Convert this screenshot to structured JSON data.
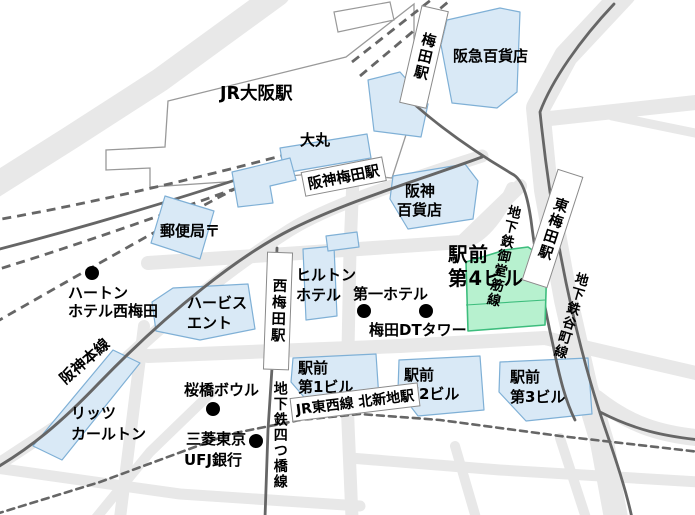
{
  "labels": {
    "jr_osaka": "JR大阪駅",
    "umeda_station": "梅田駅",
    "hankyu_dept": "阪急百貨店",
    "daimaru": "大丸",
    "hanshin_umeda_station": "阪神梅田駅",
    "hanshin_dept_line1": "阪神",
    "hanshin_dept_line2": "百貨店",
    "post_office": "郵便局〒",
    "hearton_line1": "ハートン",
    "hearton_line2": "ホテル西梅田",
    "hilton_line1": "ヒルトン",
    "hilton_line2": "ホテル",
    "daiichi_hotel": "第一ホテル",
    "umeda_dt_tower": "梅田DTタワー",
    "ekimae4_line1": "駅前",
    "ekimae4_line2": "第4ビル",
    "higashi_umeda_station": "東梅田駅",
    "midosuji_line": "地下鉄御堂筋線",
    "tanimachi_line": "地下鉄谷町線",
    "herbis_line1": "ハービス",
    "herbis_line2": "エント",
    "nishi_umeda_station": "西梅田駅",
    "hanshin_main_line": "阪神本線",
    "ekimae1_line1": "駅前",
    "ekimae1_line2": "第1ビル",
    "ekimae2_line1": "駅前",
    "ekimae2_line2": "第2ビル",
    "ekimae3_line1": "駅前",
    "ekimae3_line2": "第3ビル",
    "ritz_line1": "リッツ",
    "ritz_line2": "カールトン",
    "sakurabashi_bowl": "桜橋ボウル",
    "mufg_line1": "三菱東京",
    "mufg_line2": "UFJ銀行",
    "yotsubashi_line": "地下鉄四つ橋線",
    "kitashinchi_station": "JR東西線 北新地駅"
  },
  "colors": {
    "building_fill": "#d9e9f6",
    "building_stroke": "#7fb0d6",
    "highlight_fill": "#b7f1cf",
    "highlight_stroke": "#3dbd7d",
    "road": "#e8e8e8",
    "rail": "#666666",
    "station_area_border": "#999999",
    "station_box_border": "#8a8a8a",
    "marker": "#000000"
  }
}
